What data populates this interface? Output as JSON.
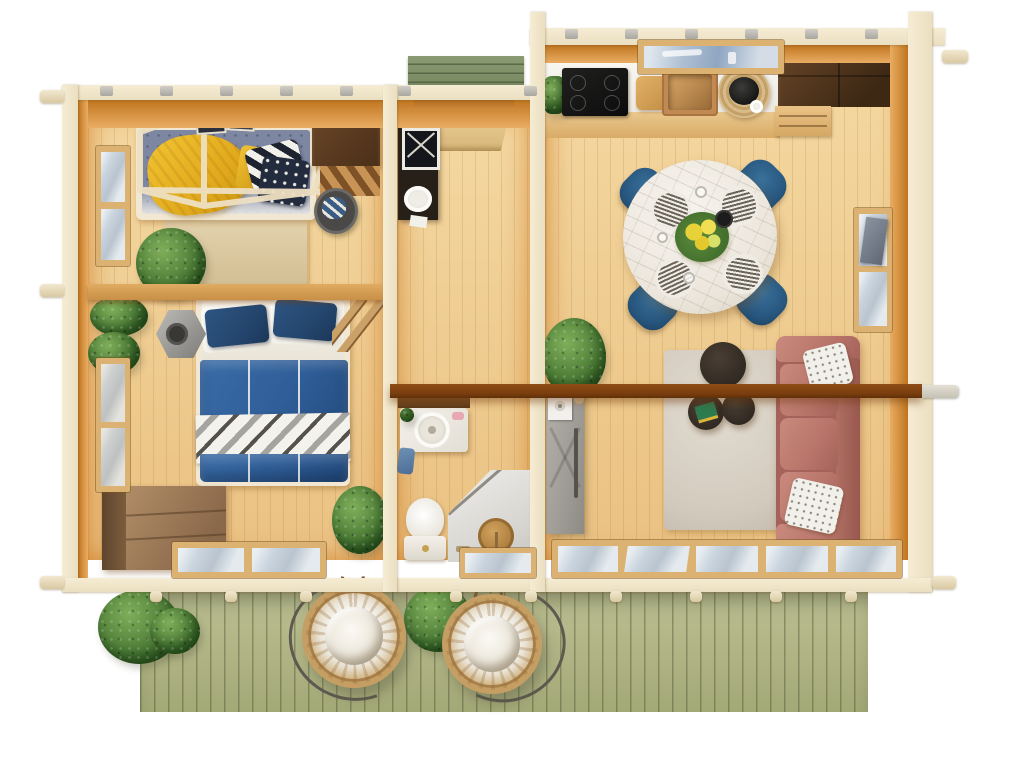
{
  "scene": {
    "type": "top-down 3D architectural floor plan render",
    "subject": "log cabin / garden house with furnished interior and front deck",
    "width_px": 1024,
    "height_px": 768,
    "background": "#ffffff",
    "visible_text": "none"
  },
  "palette": {
    "wallTop": "#eadfc0",
    "wallFace": "#e9ad63",
    "floorHi": "#f4d9a2",
    "floorLo": "#eac182",
    "beam": "#793d0e",
    "deck": "#b0b485",
    "porch": "#75865f",
    "glass": "#c9d4de",
    "plant": "#4c7c36",
    "chair": "#27567e",
    "duvet": "#2f5d97",
    "pillow": "#24466e",
    "sofa": "#b8746a",
    "marble": "#ece6dc",
    "coffee": "#2f2822",
    "blanketYellow": "#e9b426",
    "rugBedroom": "#dcc9a4",
    "rugLiving": "#d8d0c4",
    "dresser": "#ab8a62",
    "consoleBlack": "#262019",
    "cooktop": "#121212",
    "sinkCopper": "#bb8350",
    "cabinetDark": "#553823",
    "showerGray": "#e3e1dd",
    "barnDoorGray": "#a8a5a0",
    "wicker": "#c59e63"
  },
  "rooms": [
    {
      "name": "Bedroom 1",
      "furniture": [
        "single bed with canopy frame",
        "yellow blanket",
        "striped pillow",
        "cross-pattern pillow",
        "beige rug",
        "potted plant",
        "dark desk",
        "loft steps",
        "laundry basket",
        "two wall pictures",
        "side window"
      ]
    },
    {
      "name": "Bedroom 2",
      "furniture": [
        "double bed with blue duvet",
        "chevron throw",
        "two navy pillows",
        "hexagonal lantern stove",
        "wall plants",
        "chest of drawers",
        "potted plant",
        "ladder",
        "glazed side door"
      ]
    },
    {
      "name": "Entry hall",
      "furniture": [
        "front door (open)",
        "black console shelf with framed art",
        "porch step outside"
      ]
    },
    {
      "name": "Bathroom",
      "furniture": [
        "vanity with round basin",
        "soap",
        "blue towel",
        "toilet",
        "corner shower with bronze head",
        "fixtures"
      ]
    },
    {
      "name": "Kitchen",
      "furniture": [
        "white counter",
        "induction cooktop",
        "cutting board",
        "copper sink with faucet",
        "rattan tray with kettle",
        "herb pot",
        "dark wall cabinet",
        "wood drawers",
        "skylight window"
      ]
    },
    {
      "name": "Dining area",
      "furniture": [
        "round marble table",
        "4 blue chairs",
        "4 place settings",
        "glasses",
        "yellow flower centerpiece",
        "black bowl"
      ]
    },
    {
      "name": "Living room",
      "furniture": [
        "terracotta 3-seat sofa",
        "2 patterned pillows",
        "light rug",
        "3 round coffee tables",
        "books",
        "large plant",
        "gray sliding barn door",
        "overhead beam",
        "side window",
        "rear glazed doors"
      ]
    }
  ],
  "outdoor": {
    "deck": "sage-green plank terrace",
    "items": [
      "2 rattan hanging egg chairs with white cushions",
      "bush between chairs",
      "bushes at left deck edge",
      "green porch step at entry door"
    ]
  },
  "structure": {
    "walls": "log walls shown in cut view with pale tops, protruding log ends and rafter tabs",
    "beam": "dark brown collar beam spanning bathroom and living room, tip protruding through right wall",
    "windows": [
      "bedroom1 left",
      "bedroom2 left",
      "kitchen skylight",
      "living right (open sash)",
      "bedroom2 bottom",
      "bathroom bottom",
      "living bottom glazed doors"
    ]
  }
}
